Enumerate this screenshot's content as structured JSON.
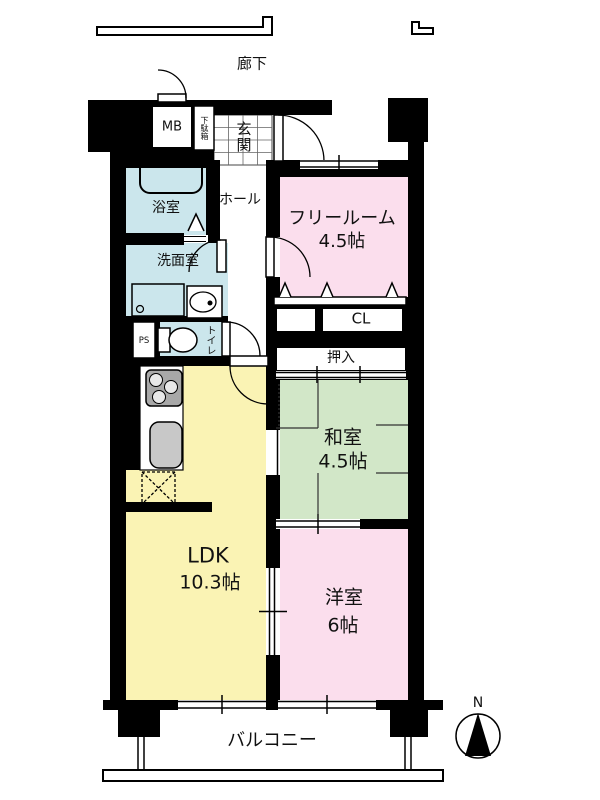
{
  "page": {
    "type": "apartment-floor-plan"
  },
  "corridor": {
    "label": "廊下"
  },
  "entrance": {
    "genkan_label": "玄関",
    "getabako_label": "下駄箱",
    "mb_label": "MB"
  },
  "sanitary": {
    "bathroom_label": "浴室",
    "washroom_label": "洗面室",
    "toilet_label": "トイレ",
    "ps_label": "PS",
    "hall_label": "ホール"
  },
  "rooms": {
    "free_room": {
      "name": "フリールーム",
      "size": "4.5帖"
    },
    "washitsu": {
      "name": "和室",
      "size": "4.5帖"
    },
    "ldk": {
      "name": "LDK",
      "size": "10.3帖"
    },
    "yoshitsu": {
      "name": "洋室",
      "size": "6帖"
    }
  },
  "storage": {
    "cl_label": "CL",
    "oshiire_label": "押入"
  },
  "balcony": {
    "label": "バルコニー"
  },
  "compass": {
    "north_label": "N"
  },
  "colors": {
    "room_pink": "#fbdeed",
    "room_green": "#d2e7c8",
    "room_yellow": "#faf3b4",
    "room_blue": "#cbe6ec",
    "wall": "#000000"
  }
}
